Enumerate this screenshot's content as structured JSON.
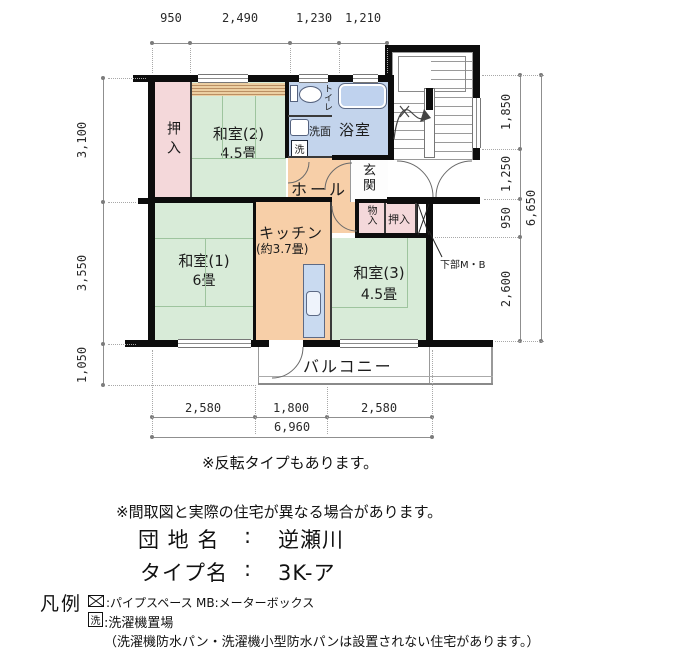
{
  "palette": {
    "tatami_green": "#d8ebd8",
    "closet_pink": "#f4d8da",
    "water_blue": "#c3d4ec",
    "hall_orange": "#f7cfa8",
    "wall_black": "#0d0d0d"
  },
  "dimensions": {
    "top": [
      "950",
      "2,490",
      "1,230",
      "1,210"
    ],
    "left": [
      "3,100",
      "3,550",
      "1,050"
    ],
    "right": [
      "1,850",
      "1,250",
      "950",
      "2,600"
    ],
    "right_total": "6,650",
    "bottom": [
      "2,580",
      "1,800",
      "2,580"
    ],
    "bottom_total": "6,960"
  },
  "rooms": {
    "oshiire_top": "押入",
    "washitsu2_name": "和室(2)",
    "washitsu2_size": "4.5畳",
    "toilet": "トイレ",
    "washroom": "洗面",
    "washer_mark": "洗",
    "bath": "浴室",
    "hall": "ホール",
    "entrance": "玄関",
    "kitchen_name": "キッチン",
    "kitchen_size": "(約3.7畳)",
    "washitsu1_name": "和室(1)",
    "washitsu1_size": "6畳",
    "storage": "物入",
    "oshiire_right": "押入",
    "washitsu3_name": "和室(3)",
    "washitsu3_size": "4.5畳",
    "balcony": "バルコニー",
    "mb_note": "下部M・B"
  },
  "notes": {
    "reverse": "※反転タイプもあります。",
    "disclaimer": "※間取図と実際の住宅が異なる場合があります。"
  },
  "info": {
    "estate_label": "団 地 名",
    "estate_sep": ":",
    "estate_name": "逆瀬川",
    "type_label": "タイプ名",
    "type_sep": ":",
    "type_name": "3K-ア"
  },
  "legend": {
    "title": "凡例",
    "pipe_space": ":パイプスペース",
    "meter_box": "MB:メーターボックス",
    "washer_symbol": "洗",
    "washer_place": ":洗濯機置場",
    "washer_note": "（洗濯機防水パン・洗濯機小型防水パンは設置されない住宅があります。）"
  }
}
